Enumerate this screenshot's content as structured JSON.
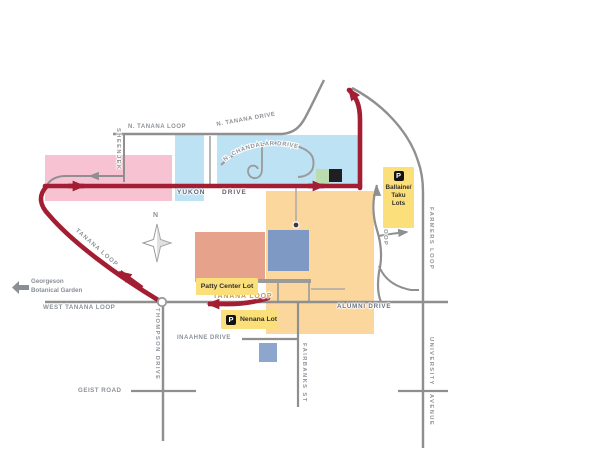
{
  "roads": {
    "n_tanana_loop": "N. TANANA LOOP",
    "n_tanana_drive": "N. TANANA DRIVE",
    "n_chandalar_drive": "N. CHANDALAR DRIVE",
    "sheenjek": "SHEENJEK",
    "yukon": "YUKON",
    "yukon_drive_word": "DRIVE",
    "tanana_loop_curve": "TANANA LOOP",
    "tanana_loop_gold": "TANANA LOOP",
    "west_tanana_loop": "WEST TANANA LOOP",
    "alumni_drive": "ALUMNI DRIVE",
    "thompson_drive": "THOMPSON DRIVE",
    "geist_road": "GEIST ROAD",
    "inaahne_drive": "INAAHNE DRIVE",
    "fairbanks_st": "FAIRBANKS ST",
    "tanana_loop_east": "TANANA LOOP",
    "farmers_loop": "FARMERS LOOP",
    "university": "UNIVERSITY",
    "avenue": "AVENUE"
  },
  "compass": {
    "north": "N"
  },
  "pointer": {
    "line1": "Georgeson",
    "line2": "Botanical Garden"
  },
  "parking": {
    "p": "P",
    "ballaine": {
      "line1": "Ballaine/",
      "line2": "Taku",
      "line3": "Lots"
    },
    "patty": "Patty Center Lot",
    "nenana": "Nenana Lot"
  },
  "colors": {
    "route_red": "#a31d33",
    "road_gray": "#8f8f8f",
    "lot_yellow": "#fbdf7b",
    "west_ridge_pink": "#f7c3d2",
    "core_blue": "#bce2f4",
    "east_orange": "#fbd79e",
    "building_salmon": "#e7a28b",
    "building_steelblue": "#7e9ac4",
    "lawn_green": "#bbdcae",
    "label_gold": "#c49b51"
  }
}
